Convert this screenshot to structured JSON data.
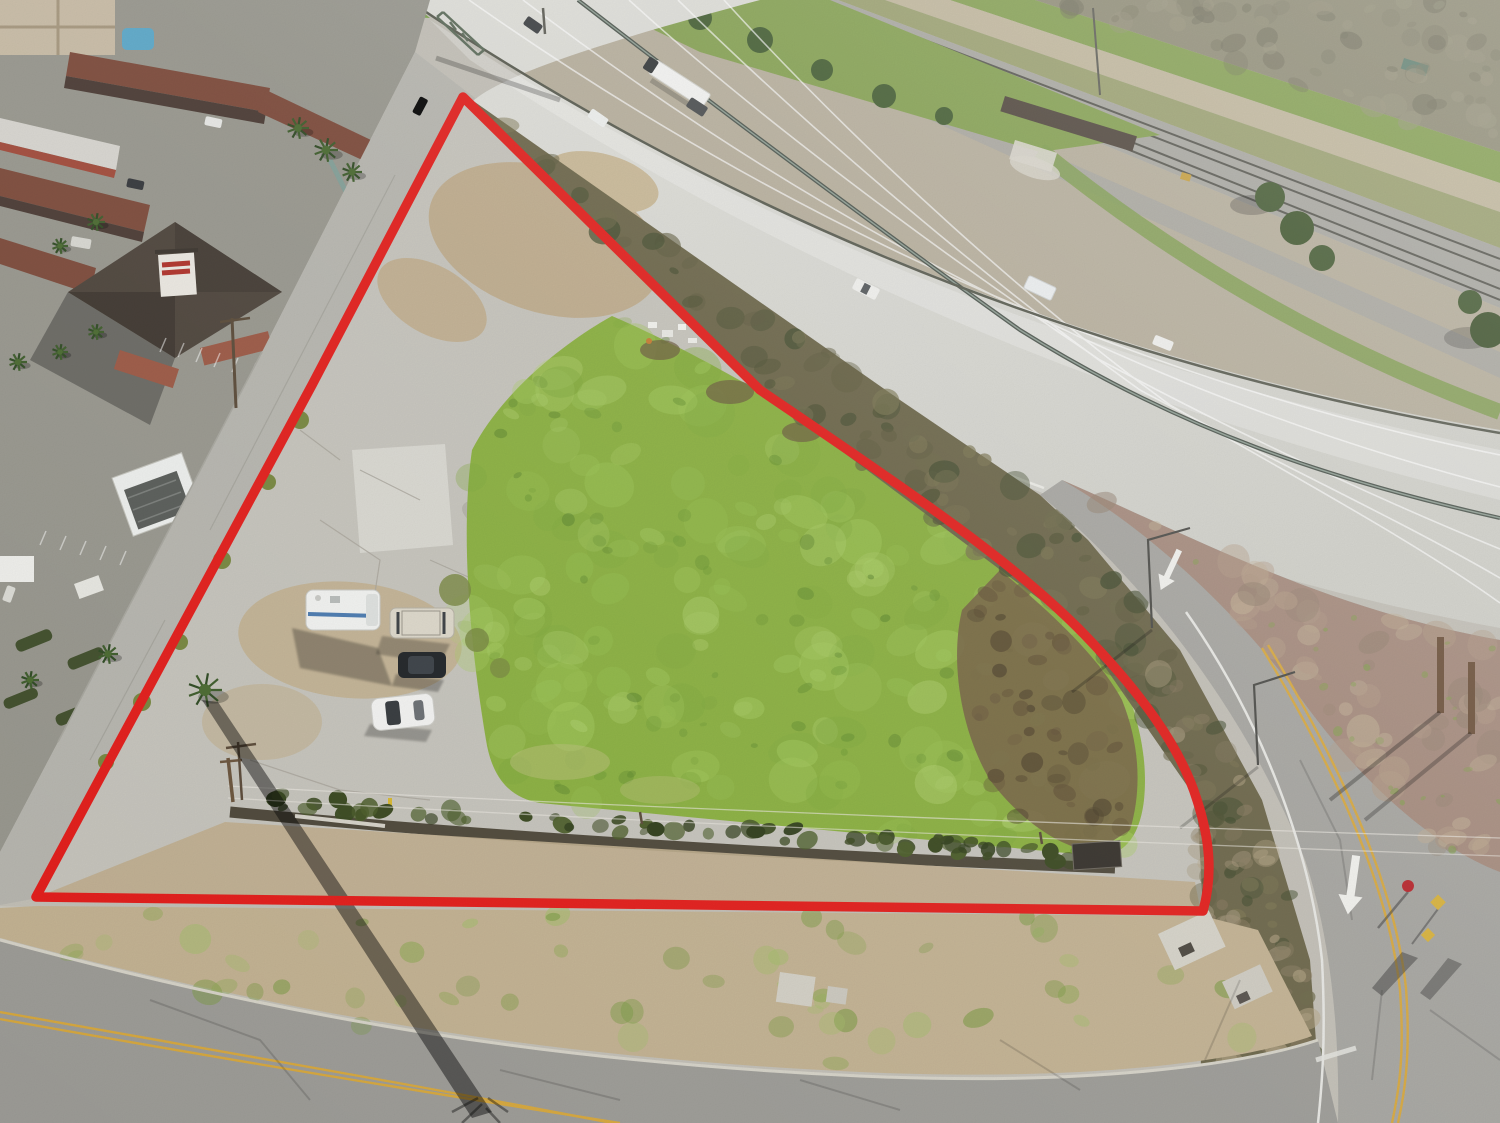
{
  "image": {
    "type": "aerial-drone-photograph",
    "subject": "vacant corner land parcel outlined in red beside a freeway interchange",
    "no_visible_text": true
  },
  "annotation": {
    "outline_color": "#e41d1a",
    "outline_width_px": 9,
    "outline_shape": "triangular parcel with curved northeast corner"
  },
  "features": [
    "freeway-with-median-barrier",
    "railroad-tracks",
    "scrub-hills",
    "motel-complex",
    "pagoda-roof-building",
    "gas-station-canopy",
    "green-field",
    "cracked-concrete-pad",
    "frontage-road-ramp",
    "drainage-ditch-hedge",
    "palm-trees",
    "power-lines"
  ],
  "vehicles": {
    "on_parcel": [
      {
        "type": "rv-camper",
        "color": "white-blue"
      },
      {
        "type": "suv",
        "color": "tan"
      },
      {
        "type": "sedan",
        "color": "black"
      },
      {
        "type": "sedan",
        "color": "white"
      }
    ],
    "on_freeway": [
      {
        "type": "semi-truck",
        "color": "white"
      },
      {
        "type": "car",
        "color": "dark"
      },
      {
        "type": "car",
        "color": "white"
      },
      {
        "type": "pickup",
        "color": "dark"
      },
      {
        "type": "pickup",
        "color": "white"
      },
      {
        "type": "box-truck",
        "color": "white"
      },
      {
        "type": "car",
        "color": "white"
      }
    ]
  },
  "road_markings": {
    "center_lines": "double-yellow",
    "white_merge_arrows": 2,
    "stop_sign": 1,
    "yellow_warning_signs": 2
  },
  "palette": {
    "outline": "#e41d1a",
    "field_base": "#8ab03f",
    "field_light": [
      "#9cc554",
      "#a8cf62",
      "#7da83a",
      "#b3d470"
    ],
    "field_dark": [
      "#4f7a26",
      "#5d8a2c",
      "#6b9831"
    ],
    "bush_strip": [
      "#5d5a3c",
      "#4a4f30",
      "#6b6848",
      "#3f4a2c",
      "#7a7450"
    ],
    "bush_dirt": [
      "#b5a585",
      "#a3957a",
      "#8a7c60"
    ],
    "scrub_hills": [
      "#7f7c66",
      "#9a967e",
      "#6f6d5a"
    ],
    "median_dirt": [
      "#c0ae93",
      "#b29a85",
      "#94806f"
    ],
    "brown_patch": [
      "#5f4e33",
      "#6b5a3d",
      "#4a3d28"
    ],
    "concrete": "#c6c4bc",
    "asphalt_street": "#9d9c97",
    "highway": "#d9d9d4",
    "yellow_line": "#d7a83e"
  }
}
